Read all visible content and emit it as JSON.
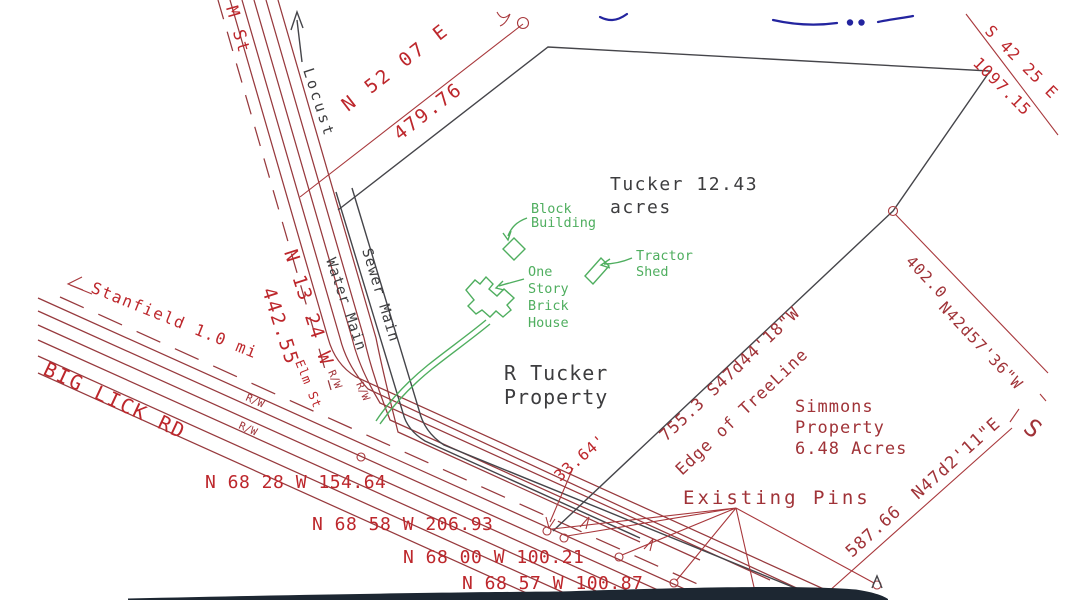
{
  "drawing": {
    "streets": {
      "elm_top_label": "M St",
      "elm_label": "Elm St",
      "locust_label": "Locust",
      "big_lick_label": "BIG LICK RD",
      "stanfield_label": "Stanfield 1.0 mi",
      "right_of_way_label": "R/W"
    },
    "utilities": {
      "water_main_label": "Water Main",
      "sewer_main_label": "Sewer Main"
    },
    "parcels": {
      "tucker_acreage_line1": "Tucker 12.43",
      "tucker_acreage_line2": "acres",
      "tucker_owner_line1": "R Tucker",
      "tucker_owner_line2": "Property",
      "simmons_line1": "Simmons",
      "simmons_line2": "Property",
      "simmons_line3": "6.48 Acres"
    },
    "bearings": {
      "locust_rw": {
        "bearing": "N 52 07 E",
        "distance": "479.76"
      },
      "northeast": {
        "bearing": "S 42 25 E",
        "distance": "1097.15"
      },
      "elm_rw": {
        "bearing": "N 13 24 W",
        "distance": "442.55"
      },
      "simmons_north": {
        "distance": "402.0",
        "bearing": "N42d57'36\"W"
      },
      "treeline": {
        "label": "755.3  S47d44'18\"W",
        "edge_label": "Edge of TreeLine"
      },
      "simmons_east": {
        "distance": "587.66",
        "bearing": "N47d2'11\"E"
      },
      "big_lick_segments": [
        "N 68 28 W 154.64",
        "N 68 58 W 206.93",
        "N 68 00 W 100.21",
        "N 68 57 W 100.87"
      ],
      "tie_distance": "33.64'",
      "partial_s": "S"
    },
    "buildings": {
      "block_line1": "Block",
      "block_line2": "Building",
      "house_line1": "One",
      "house_line2": "Story",
      "house_line3": "Brick",
      "house_line4": "House",
      "shed_line1": "Tractor",
      "shed_line2": "Shed"
    },
    "annotations": {
      "existing_pins": "Existing Pins"
    },
    "colors": {
      "road_red": "#97393d",
      "text_red": "#bd272c",
      "line_black": "#45454a",
      "green": "#4fae5f",
      "blue": "#23249f",
      "scan_band": "#1d2732"
    }
  }
}
